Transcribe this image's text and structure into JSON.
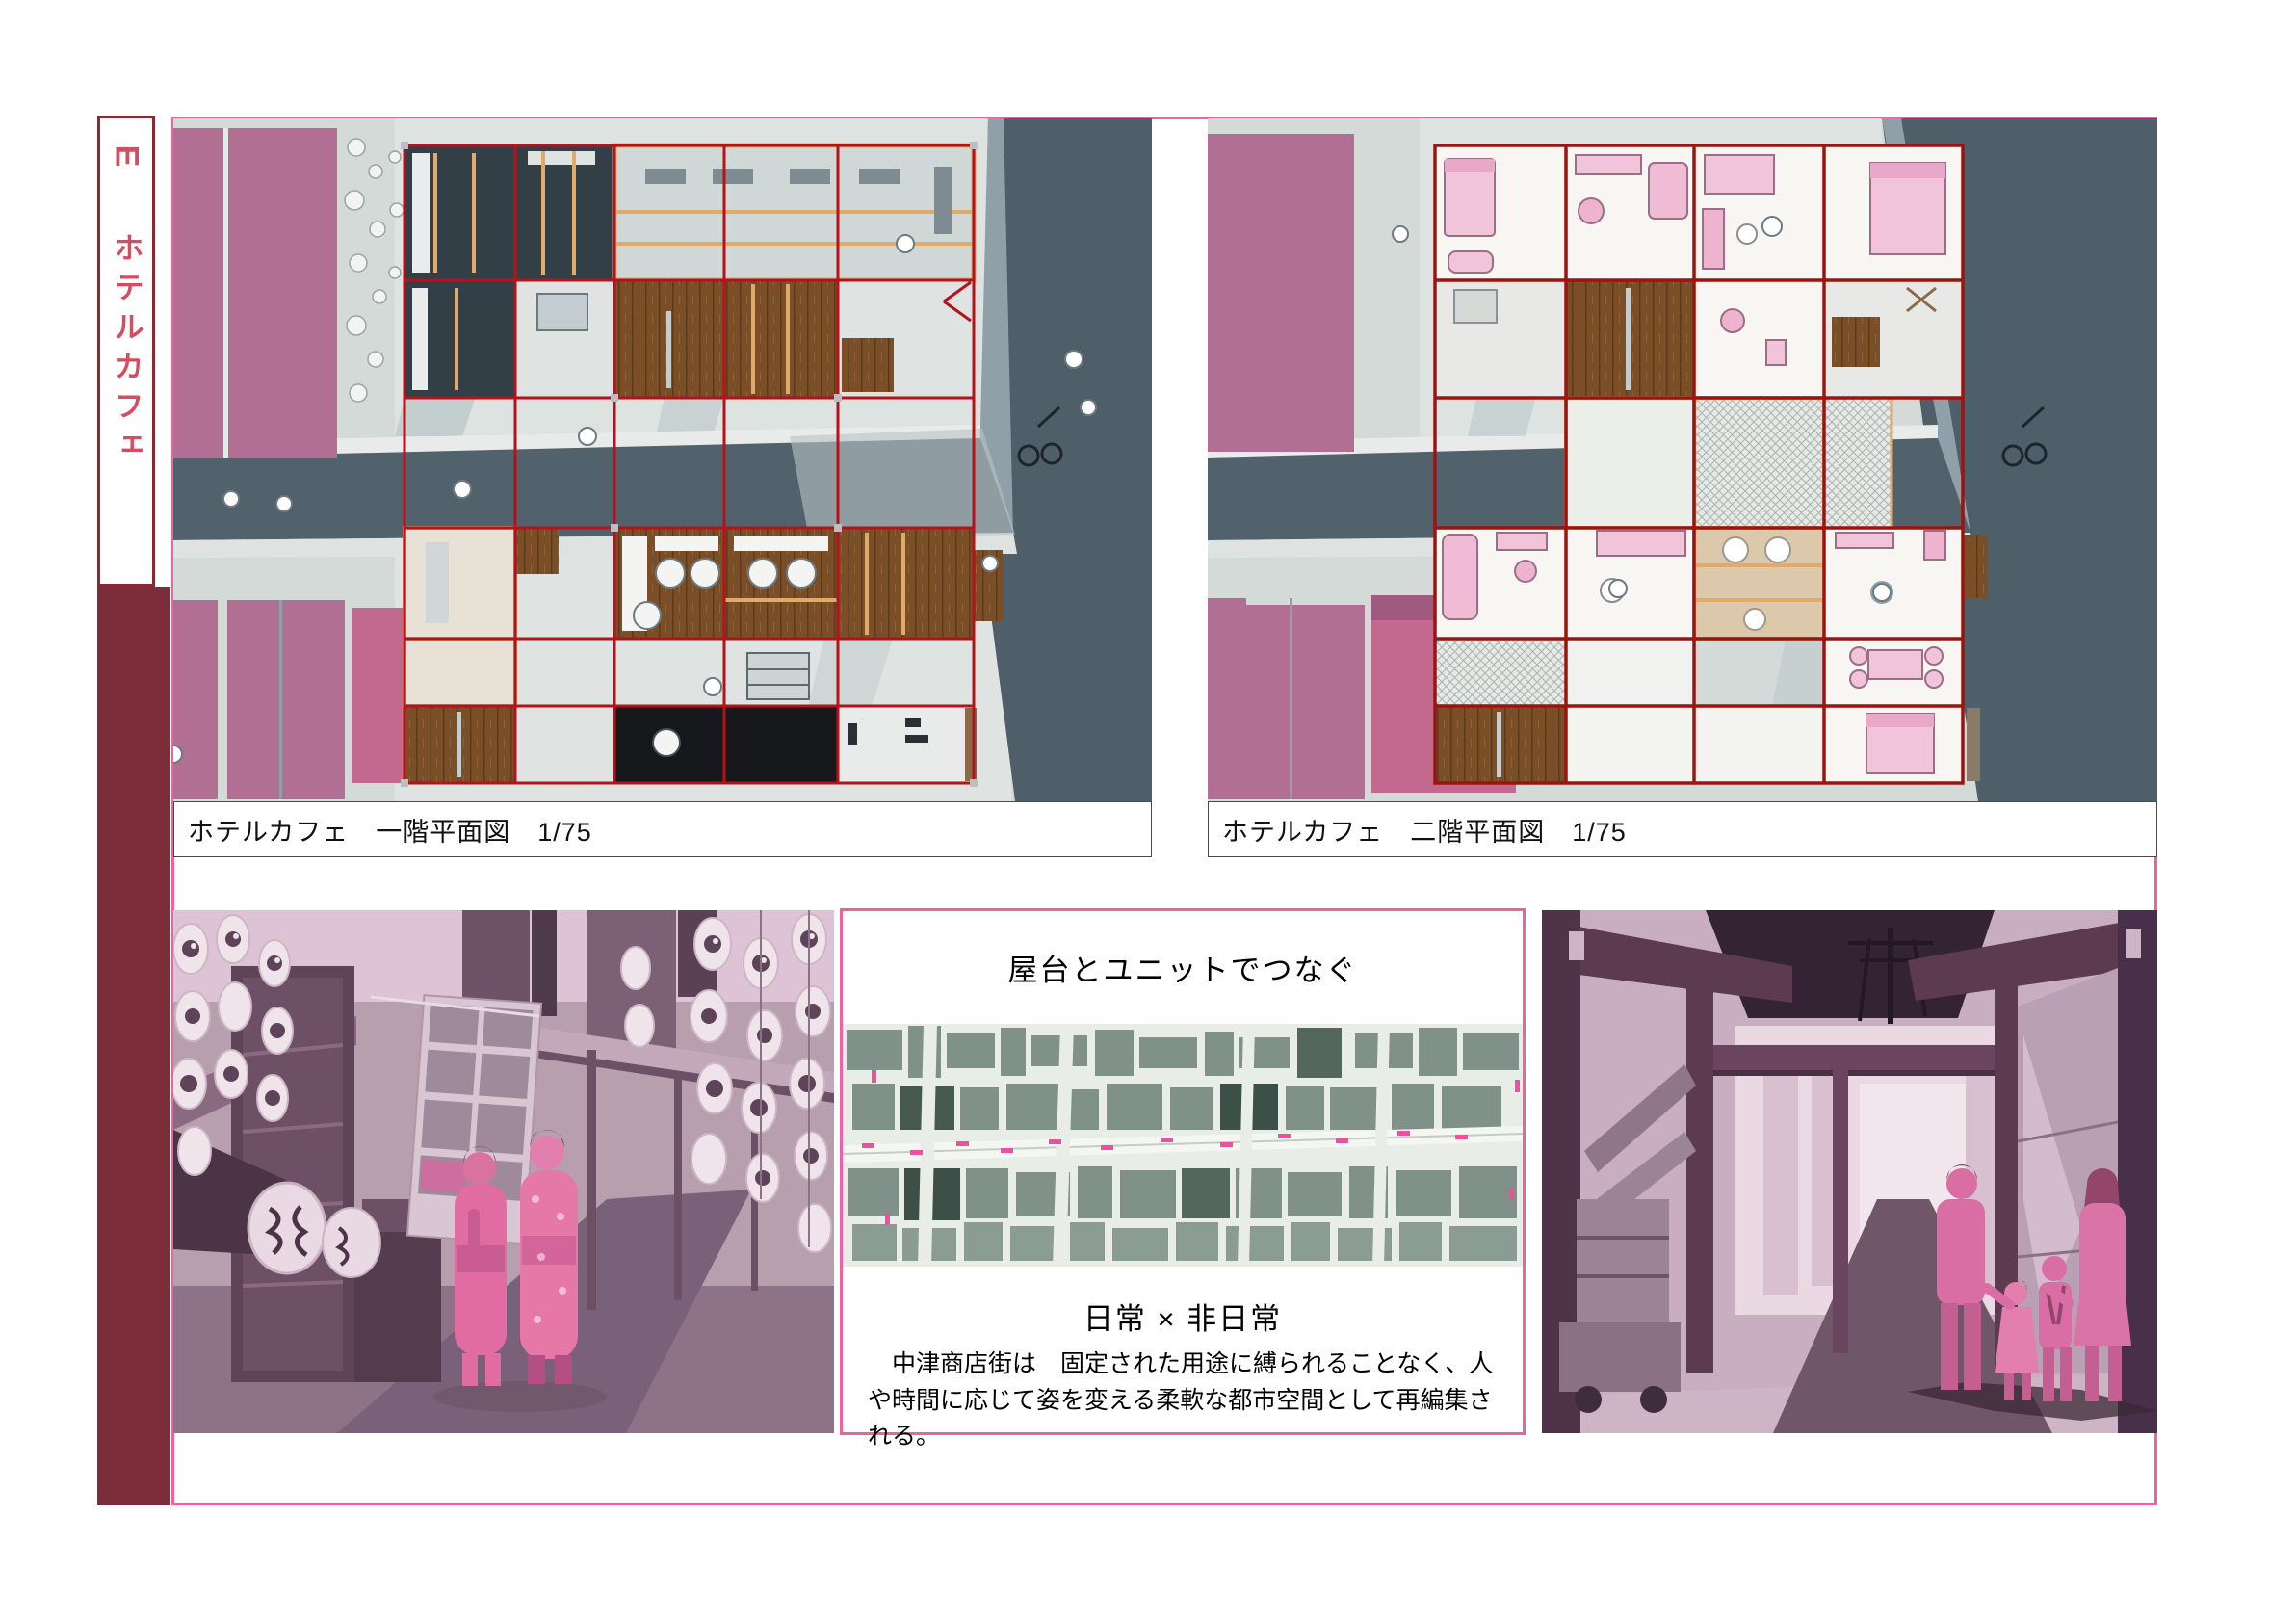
{
  "page": {
    "type": "architecture-presentation-board"
  },
  "sidebar": {
    "tab_letter": "E",
    "tab_title": "ホテルカフェ"
  },
  "plans": {
    "first": {
      "caption": "ホテルカフェ　一階平面図　1/75"
    },
    "second": {
      "caption": "ホテルカフェ　二階平面図　1/75"
    }
  },
  "concept": {
    "title": "屋台とユニットでつなぐ",
    "subtitle": "日常 × 非日常",
    "body": "中津商店街は　固定された用途に縛られることなく、人や時間に応じて姿を変える柔軟な都市空間として再編集される。"
  },
  "colors": {
    "frame_pink": "#f0619f",
    "maroon_bar": "#7b2d3a",
    "tab_red": "#d94b60",
    "unit_grid_red": "#b5121b",
    "building_pink": "#b26f94",
    "building_pink_bright": "#c3688f",
    "road_slate": "#51626c",
    "ground_gray": "#d3dad8",
    "wood_brown": "#7a4f28",
    "frame_tan": "#e0aa6a",
    "photo_figure_pink": "#d86ea3",
    "photo_structure_maroon": "#5c3a50",
    "map_building_green": "#7f9189",
    "map_marker_pink": "#ee4f9e"
  }
}
